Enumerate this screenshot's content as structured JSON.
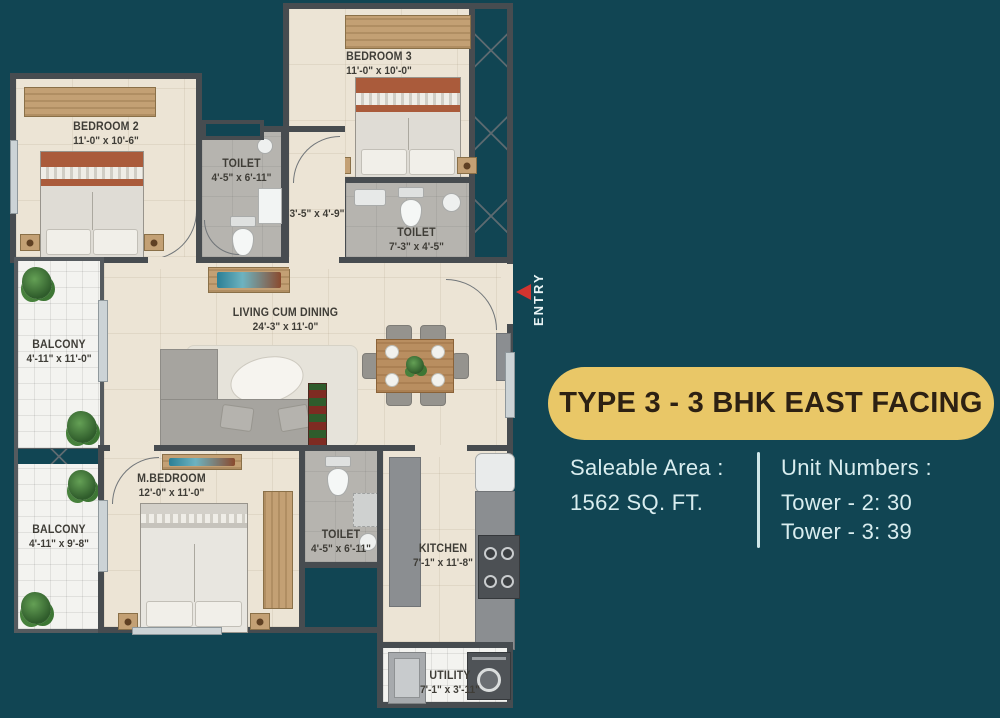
{
  "title_panel": {
    "title": "TYPE 3 - 3 BHK EAST FACING",
    "saleable_area_label": "Saleable Area :",
    "saleable_area_value": "1562 SQ. FT.",
    "unit_numbers_label": "Unit Numbers :",
    "unit_tower_2": "Tower - 2: 30",
    "unit_tower_3": "Tower - 3: 39"
  },
  "entry": {
    "label": "ENTRY"
  },
  "rooms": [
    {
      "name": "BEDROOM 2",
      "dims": "11'-0\" x 10'-6\""
    },
    {
      "name": "BEDROOM 3",
      "dims": "11'-0\" x 10'-0\""
    },
    {
      "name": "TOILET",
      "dims": "4'-5\" x 6'-11\""
    },
    {
      "name": "TOILET",
      "dims": "7'-3\" x 4'-5\""
    },
    {
      "name": "LIVING CUM DINING",
      "dims": "24'-3\" x 11'-0\""
    },
    {
      "name": "BALCONY",
      "dims": "4'-11\" x 11'-0\""
    },
    {
      "name": "BALCONY",
      "dims": "4'-11\" x 9'-8\""
    },
    {
      "name": "M.BEDROOM",
      "dims": "12'-0\" x 11'-0\""
    },
    {
      "name": "TOILET",
      "dims": "4'-5\" x 6'-11\""
    },
    {
      "name": "KITCHEN",
      "dims": "7'-1\" x 11'-8\""
    },
    {
      "name": "UTILITY",
      "dims": "7'-1\" x 3'-11\""
    },
    {
      "name": "",
      "dims": "3'-5\" x 4'-9\""
    }
  ],
  "icons": {
    "entry_arrow": "red-left-triangle"
  },
  "colors": {
    "background": "#114553",
    "pill_background": "#e9c767",
    "pill_text": "#2d2113",
    "panel_text": "#d9edef",
    "wall": "#474c50",
    "arrow_red": "#d23430"
  }
}
